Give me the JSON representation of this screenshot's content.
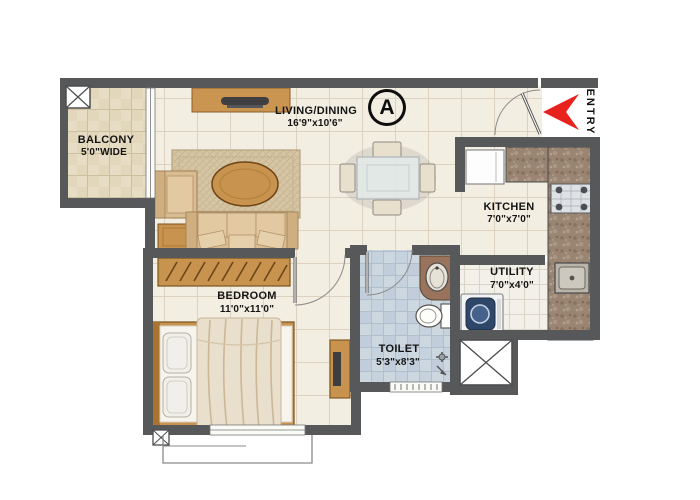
{
  "plan": {
    "marker": {
      "label": "A"
    },
    "entry": {
      "label": "ENTRY"
    },
    "rooms": {
      "living": {
        "name": "LIVING/DINING",
        "dims": "16'9\"x10'6\""
      },
      "balcony": {
        "name": "BALCONY",
        "dims": "5'0\"WIDE"
      },
      "kitchen": {
        "name": "KITCHEN",
        "dims": "7'0\"x7'0\""
      },
      "utility": {
        "name": "UTILITY",
        "dims": "7'0\"x4'0\""
      },
      "bedroom": {
        "name": "BEDROOM",
        "dims": "11'0\"x11'0\""
      },
      "toilet": {
        "name": "TOILET",
        "dims": "5'3\"x8'3\""
      }
    },
    "colors": {
      "wall": "#57585a",
      "entry_arrow": "#e8221c",
      "floor_tile": "#f3eee2",
      "balcony_tile": "#e7ddc4",
      "toilet_tile": "#ccd7e0",
      "counter_granite": "#9a8573",
      "wood": "#c8924f"
    }
  }
}
